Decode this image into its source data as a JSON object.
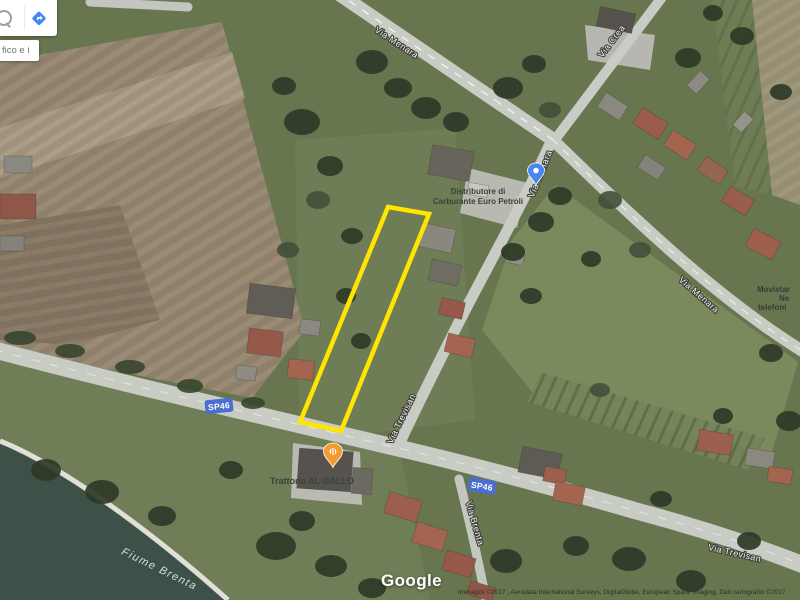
{
  "window": {
    "width": 800,
    "height": 600,
    "app": "Google Maps satellite view"
  },
  "search_card": {
    "clipped_label_text": "fico e i",
    "icons": [
      "search-icon",
      "directions-icon"
    ]
  },
  "road_labels": {
    "via_menara_top": "Via Menara",
    "via_menara_junction": "Via Menara",
    "via_menara_east": "Via Menara",
    "via_crea": "Via Crea",
    "via_trevisan_north": "Via Trevisan",
    "via_trevisan_east": "Via Trevisan",
    "via_brenta": "Via Brenta",
    "sp46": "SP46",
    "fiume_brenta": "Fiume Brenta"
  },
  "pois": {
    "fuel_station": {
      "line1": "Distributore di",
      "line2": "Carburante Euro Petroli",
      "pin": "blue-map-pin"
    },
    "restaurant": {
      "name": "Trattoria AL GALLO",
      "pin": "orange-restaurant-pin"
    },
    "phone_shop": {
      "line1": "Movistar",
      "line2": "Ne",
      "line3": "telefoni"
    }
  },
  "attribution": {
    "logo": "Google",
    "copyright": "Immagini ©2017 , Aerodata International Surveys, DigitalGlobe, European Space Imaging, Dati cartografici ©2017"
  },
  "colors": {
    "parcel_outline": "#ffe500",
    "road_shield_blue": "#4a6fd1",
    "pin_blue": "#4a86f0",
    "pin_orange": "#f39b2d",
    "directions_icon_blue": "#4285f4"
  }
}
